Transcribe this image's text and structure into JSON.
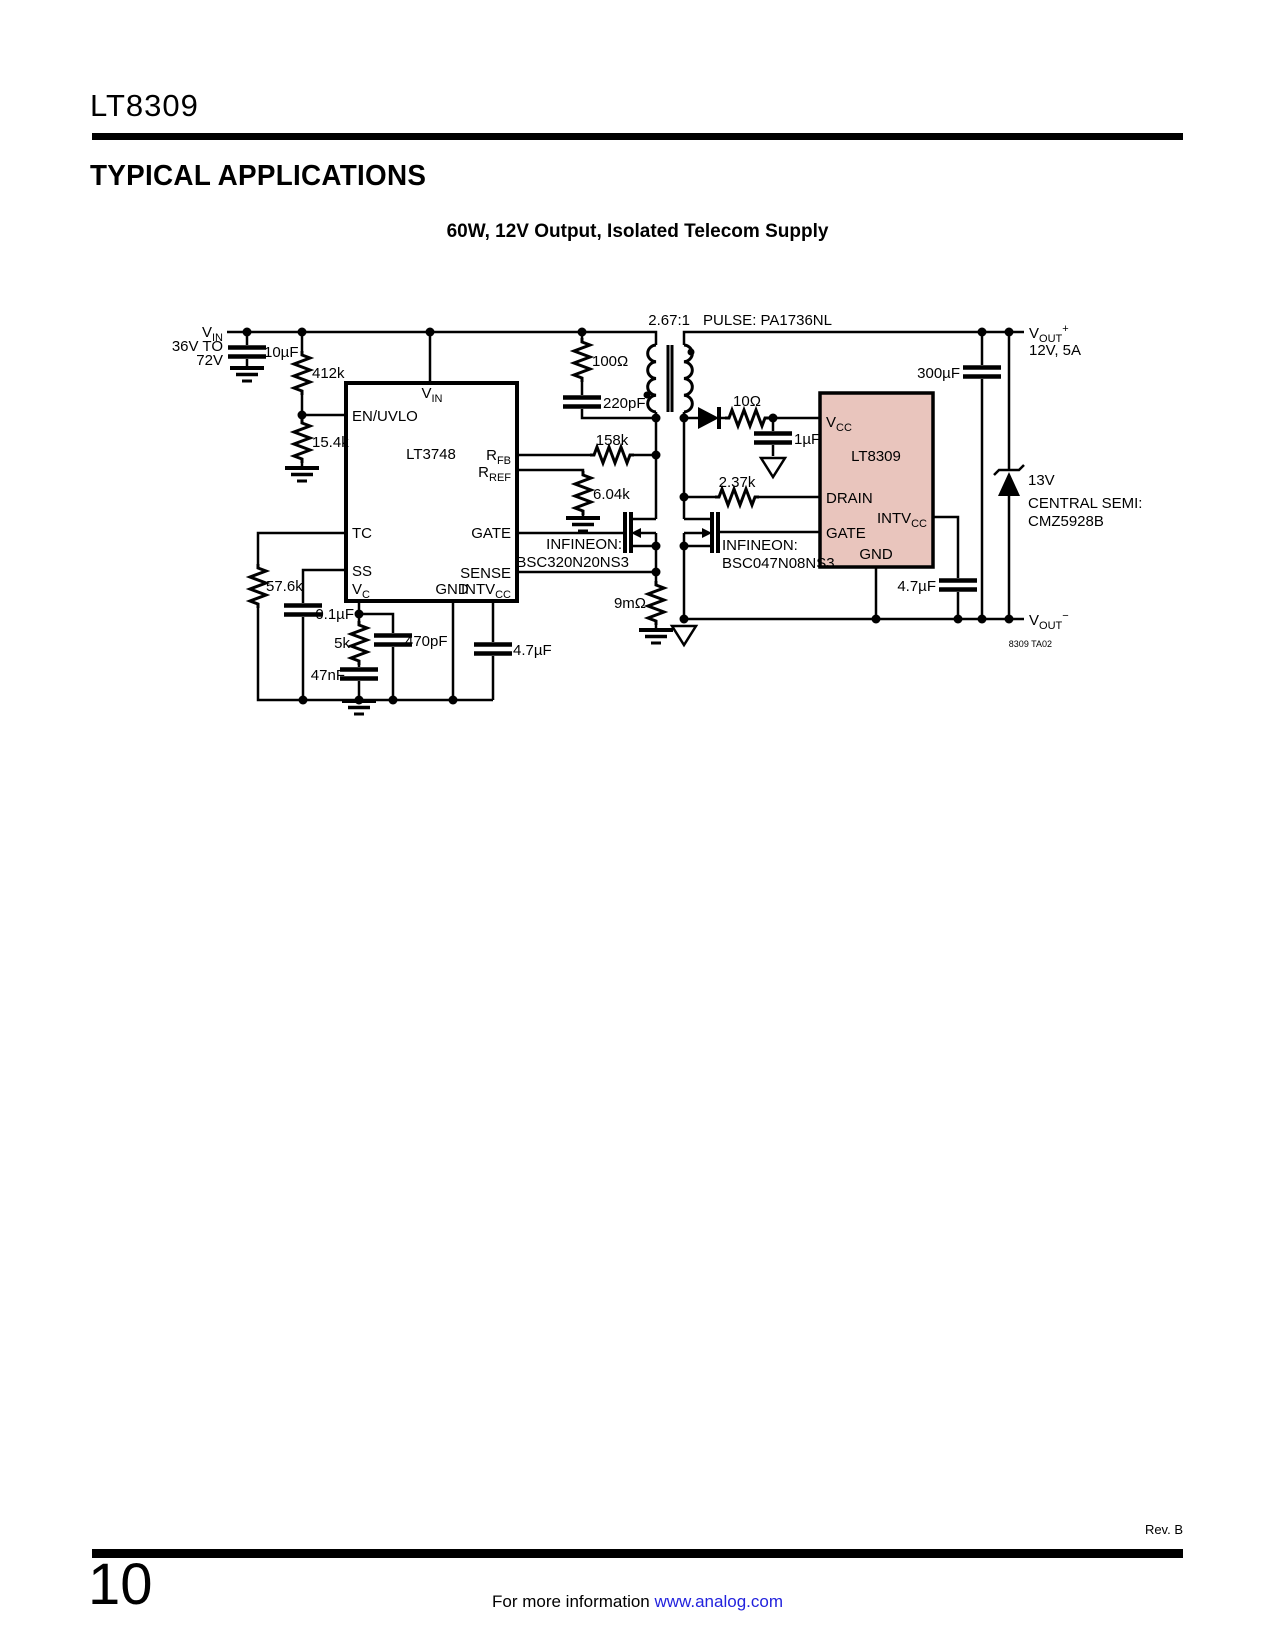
{
  "header": {
    "part": "LT8309",
    "section": "TYPICAL APPLICATIONS",
    "circuit_title": "60W, 12V Output, Isolated Telecom Supply"
  },
  "footer": {
    "rev": "Rev. B",
    "page": "10",
    "info": "For more information ",
    "link": "www.analog.com"
  },
  "colors": {
    "chip_fill": "#e9c5bd",
    "link": "#2222dd",
    "ink": "#000000"
  },
  "sch": {
    "vin_b": "V",
    "vin_s": "IN",
    "vin_l1": "36V TO",
    "vin_l2": "72V",
    "cin": "10µF",
    "r1": "412k",
    "r2": "15.4k",
    "u1_name": "LT3748",
    "pin_vin_b": "V",
    "pin_vin_s": "IN",
    "pin_enuvlo": "EN/UVLO",
    "pin_tc": "TC",
    "pin_ss": "SS",
    "pin_vc_b": "V",
    "pin_vc_s": "C",
    "pin_rfb_b": "R",
    "pin_rfb_s": "FB",
    "pin_rref_b": "R",
    "pin_rref_s": "REF",
    "pin_gate": "GATE",
    "pin_sense": "SENSE",
    "pin_gnd": "GND",
    "pin_intv_b": "INTV",
    "pin_intv_s": "CC",
    "r_tc": "57.6k",
    "c_ss": "0.1µF",
    "r_vc": "5k",
    "c_vc": "47nF",
    "c_comp": "470pF",
    "c_intv1": "4.7µF",
    "r_snub": "100Ω",
    "c_snub": "220pF",
    "ratio": "2.67:1",
    "xfmr": "PULSE: PA1736NL",
    "r_fb": "158k",
    "r_ref": "6.04k",
    "q1_a": "INFINEON:",
    "q1_b": "BSC320N20NS3",
    "r_sns": "9mΩ",
    "r_vcc": "10Ω",
    "c_vcc": "1µF",
    "r_drn": "2.37k",
    "q2_a": "INFINEON:",
    "q2_b": "BSC047N08NS3",
    "u2_name": "LT8309",
    "u2_vcc_b": "V",
    "u2_vcc_s": "CC",
    "u2_drain": "DRAIN",
    "u2_gate": "GATE",
    "u2_intv_b": "INTV",
    "u2_intv_s": "CC",
    "u2_gnd": "GND",
    "c_intv2": "4.7µF",
    "c_out": "300µF",
    "z_v": "13V",
    "z_mfr": "CENTRAL SEMI:",
    "z_part": "CMZ5928B",
    "voutp_b": "V",
    "voutp_s": "OUT",
    "voutp_p": "+",
    "voutp_r": "12V, 5A",
    "voutn_b": "V",
    "voutn_s": "OUT",
    "voutn_p": "−",
    "fig": "8309 TA02"
  }
}
